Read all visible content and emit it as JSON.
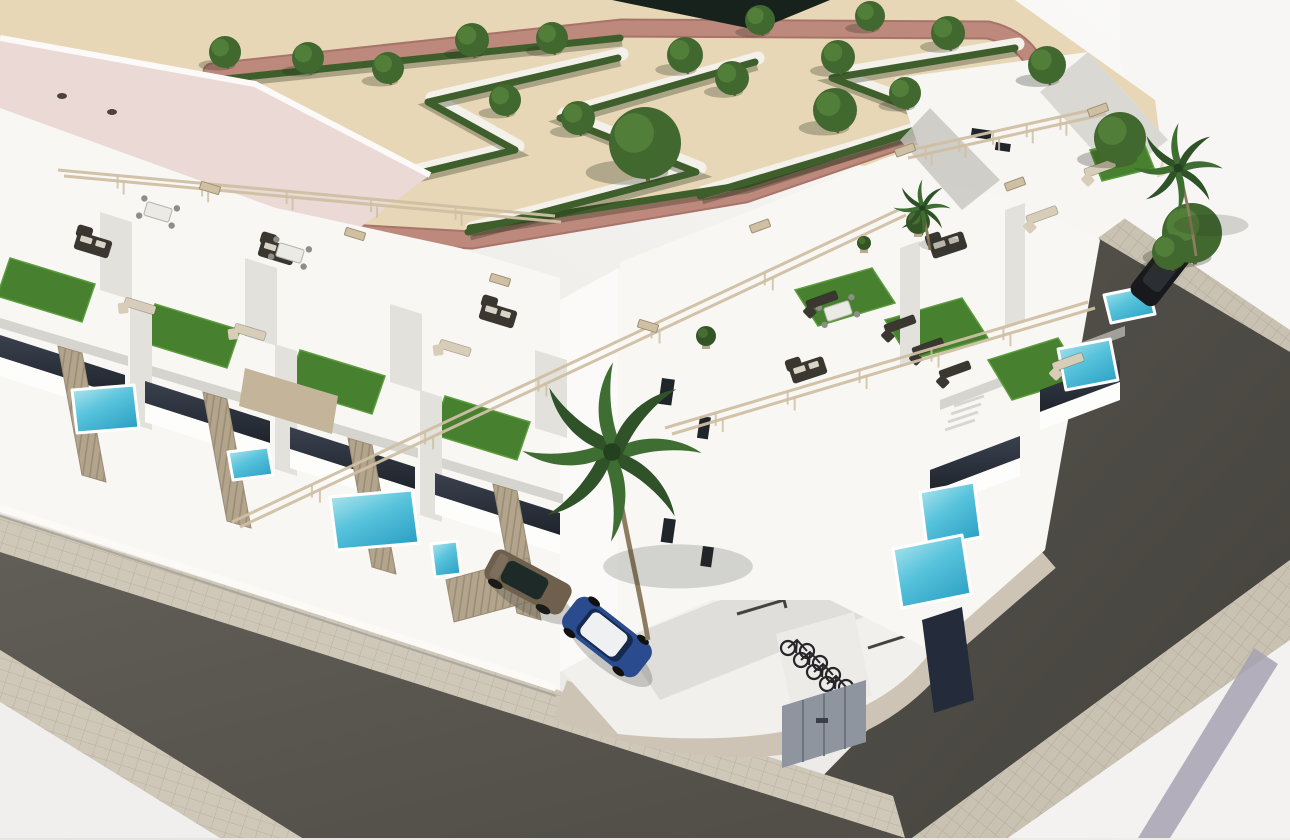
{
  "meta": {
    "scene": "aerial-3d-render-residential-development",
    "width": 1290,
    "height": 840
  },
  "colors": {
    "bg_light": "#fbfaf9",
    "bg_shade": "#e6e4e1",
    "sand": "#e7d7b6",
    "sand_shade": "#dcc9a4",
    "path_pink": "#bd897c",
    "path_pink_dark": "#a8746a",
    "path_white": "#f4f1ea",
    "hedge": "#3e5f2b",
    "tree": "#41682f",
    "tree_light": "#5b8a3e",
    "trunk": "#6d563b",
    "white_wall": "#f8f7f4",
    "wall_bright": "#fdfdfb",
    "wall_shade": "#e3e1dc",
    "wall_dark": "#c6c4be",
    "recess": "#8e8c86",
    "glass_dark": "#20242b",
    "glass_blue": "#242b3a",
    "roof_pink": "#ead9d4",
    "turf": "#47802f",
    "turf_light": "#5d9c3c",
    "pool_light": "#b9e9ee",
    "pool": "#58c3dc",
    "pool_dark": "#2fa3c6",
    "asphalt": "#5b5951",
    "asphalt_dark": "#4a483f",
    "paver": "#cfc7b8",
    "paver_line": "#b9af9e",
    "fence": "#b3a48c",
    "fence_dark": "#9a8c76",
    "beam": "#cfc0a4",
    "sofa": "#3a3731",
    "lounger": "#d7cdb8",
    "car_blue": "#2b4b8f",
    "car_white_roof": "#eef0f2",
    "car_bronze": "#6e604d",
    "car_black": "#17191c",
    "bike": "#26262a",
    "metal_gray": "#8e959e",
    "stripe_gray": "#a6a2b2"
  },
  "ground": {
    "sand_poly": "0,0 1015,0 1155,100 1165,175 1040,215 860,165 662,212 462,250 250,236 0,130",
    "dark_wedge": "612,0 830,0 757,30",
    "pink_path": "M 212,72 L 622,28 L 988,30 Q 1038,42 1042,92 L 745,194 L 472,240 L 330,232 Q 242,164 212,72 Z",
    "white_paths": [
      "302,198 518,146 432,98 622,54",
      "472,228 700,168 564,114 758,58",
      "704,192 952,118 836,74 1018,44"
    ],
    "hedges": [
      "215,80 620,38",
      "470,228 745,185 1032,92",
      "300,202 515,150 428,102 618,58",
      "468,232 696,172 560,118 755,62",
      "700,196 948,122 832,78 1015,48"
    ],
    "trees": [
      [
        225,
        52,
        16
      ],
      [
        308,
        58,
        16
      ],
      [
        388,
        68,
        16
      ],
      [
        472,
        40,
        17
      ],
      [
        552,
        38,
        16
      ],
      [
        685,
        55,
        18
      ],
      [
        732,
        78,
        17
      ],
      [
        760,
        20,
        15
      ],
      [
        838,
        57,
        17
      ],
      [
        870,
        16,
        15
      ],
      [
        948,
        33,
        17
      ],
      [
        505,
        100,
        16
      ],
      [
        578,
        118,
        17
      ],
      [
        835,
        110,
        22
      ],
      [
        905,
        93,
        16
      ],
      [
        1047,
        65,
        19
      ],
      [
        1120,
        138,
        26
      ],
      [
        645,
        143,
        36
      ],
      [
        1192,
        233,
        30
      ],
      [
        1170,
        252,
        18
      ]
    ]
  },
  "terraces": {
    "turf": [
      "10,258 95,284 82,322 -3,296",
      "155,304 240,330 227,368 142,342",
      "300,350 385,376 372,414 287,388",
      "445,396 530,422 517,460 432,434",
      "795,290 872,268 895,303 818,326",
      "885,320 962,298 988,338 910,360",
      "988,360 1058,338 1083,378 1012,400",
      "1090,150 1142,138 1154,168 1102,181"
    ],
    "sofas": [
      [
        93,
        245,
        17
      ],
      [
        277,
        252,
        17
      ],
      [
        498,
        315,
        17
      ],
      [
        808,
        370,
        -18
      ],
      [
        948,
        245,
        -18
      ]
    ],
    "dining": [
      [
        158,
        212,
        17
      ],
      [
        290,
        253,
        17
      ],
      [
        838,
        311,
        -18
      ]
    ],
    "loungers": [
      [
        140,
        306,
        17,
        1
      ],
      [
        250,
        332,
        17,
        1
      ],
      [
        455,
        348,
        17,
        1
      ],
      [
        822,
        300,
        -20,
        0
      ],
      [
        900,
        324,
        -20,
        0
      ],
      [
        928,
        347,
        -20,
        0
      ],
      [
        955,
        370,
        -20,
        0
      ],
      [
        1100,
        168,
        -20,
        1
      ],
      [
        1042,
        215,
        -20,
        1
      ],
      [
        1068,
        362,
        -20,
        1
      ]
    ],
    "rails": [
      [
        58,
        170,
        555,
        216
      ],
      [
        64,
        176,
        561,
        222
      ],
      [
        232,
        522,
        898,
        210
      ],
      [
        240,
        527,
        906,
        215
      ],
      [
        665,
        428,
        1088,
        302
      ],
      [
        672,
        434,
        1095,
        308
      ],
      [
        902,
        152,
        1100,
        108
      ],
      [
        908,
        158,
        1106,
        114
      ]
    ],
    "caps": [
      [
        210,
        188,
        17
      ],
      [
        355,
        234,
        17
      ],
      [
        500,
        280,
        17
      ],
      [
        648,
        326,
        17
      ],
      [
        905,
        150,
        -20
      ],
      [
        1015,
        184,
        -20
      ],
      [
        760,
        226,
        -20
      ],
      [
        1098,
        110,
        -20
      ]
    ],
    "plants": [
      [
        706,
        336,
        10
      ],
      [
        864,
        243,
        7
      ],
      [
        918,
        222,
        12
      ]
    ]
  },
  "facades": {
    "shade_strips": [
      "0,318 128,356 128,366 0,328",
      "145,364 273,402 273,412 145,374",
      "290,410 418,448 418,458 290,420",
      "435,456 563,494 563,504 435,466",
      "940,400 1030,366 1030,376 940,410",
      "1045,356 1125,326 1125,336 1045,366"
    ],
    "back_dividers": [
      "100,212 132,222 132,300 100,290",
      "245,258 277,268 277,346 245,336",
      "390,304 422,314 422,392 390,382",
      "535,350 567,360 567,438 535,428"
    ],
    "dividers": [
      "130,298 152,305 152,430 130,423",
      "275,344 297,351 297,476 275,469",
      "420,390 442,397 442,522 420,515",
      "900,248 920,241 920,360 900,367",
      "1005,210 1025,203 1025,322 1005,329"
    ],
    "glass_bands": [
      "0,335 125,375 125,397 0,357",
      "145,381 270,421 270,443 145,403",
      "290,427 415,467 415,489 290,449",
      "435,473 560,513 560,535 435,495",
      "930,470 1020,436 1020,458 930,492",
      "1040,390 1120,360 1120,382 1040,412"
    ],
    "slabs": [
      "0,357 125,397 125,416 0,376",
      "145,403 270,443 270,462 145,422",
      "290,449 415,489 415,508 290,468",
      "435,495 560,535 560,554 435,514",
      "930,492 1020,458 1020,476 930,510",
      "1040,412 1120,382 1120,400 1040,430"
    ],
    "windows": [
      [
        662,
        378,
        13,
        26
      ],
      [
        700,
        416,
        11,
        22
      ],
      [
        664,
        518,
        12,
        24
      ],
      [
        703,
        546,
        11,
        20
      ],
      [
        972,
        128,
        20,
        9
      ],
      [
        996,
        142,
        15,
        8
      ]
    ]
  },
  "gardens": {
    "fences": [
      "58,346 82,353 106,482 82,475",
      "203,392 227,399 251,528 227,521",
      "348,438 372,445 396,574 372,567",
      "493,484 517,491 541,620 517,613",
      "446,580 528,558 536,600 454,622"
    ],
    "pools": [
      "72,390 134,385 139,428 77,433",
      "228,452 268,447 273,475 233,480",
      "330,497 412,490 419,543 337,550",
      "431,544 457,541 461,574 435,577",
      "1104,295 1148,286 1155,314 1111,323",
      "1058,349 1110,339 1118,380 1066,390",
      "920,492 974,482 981,537 927,547",
      "893,549 962,535 971,594 902,608"
    ]
  },
  "street": {
    "bay_lines": [
      "652,588 698,575 700,583",
      "737,614 784,600 786,608",
      "868,648 915,633 917,641"
    ],
    "bikes": [
      [
        788,
        640
      ],
      [
        801,
        652
      ],
      [
        814,
        664
      ],
      [
        827,
        676
      ]
    ],
    "palms": [
      [
        612,
        452,
        2.2,
        "M648,640 C640,590 622,520 614,458"
      ],
      [
        1178,
        168,
        1.1,
        "M1196,256 C1192,225 1186,196 1179,170"
      ],
      [
        922,
        208,
        0.7,
        "M930,250 C928,235 925,222 922,210"
      ]
    ]
  }
}
